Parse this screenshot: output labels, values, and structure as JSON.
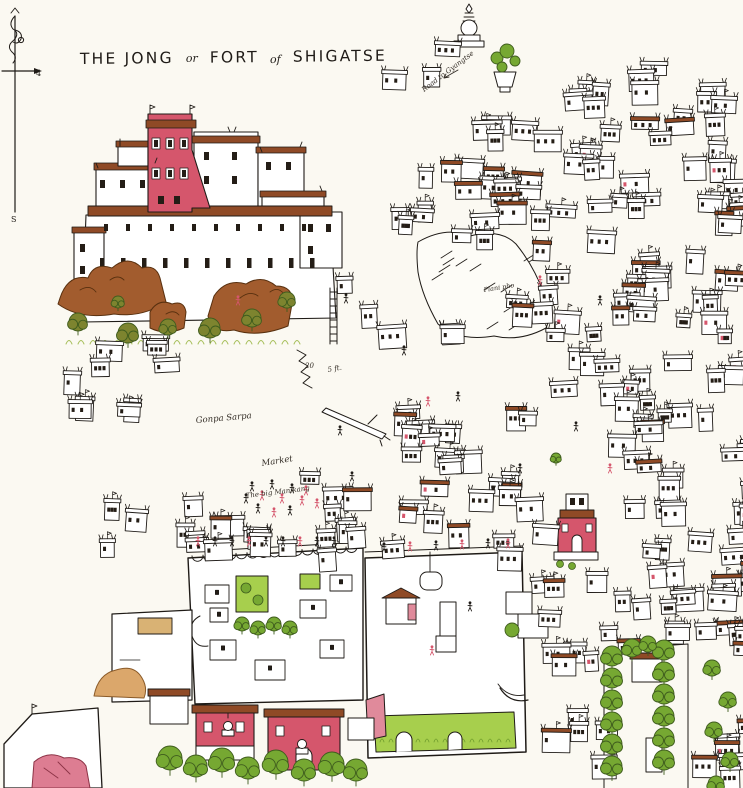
{
  "map": {
    "title": {
      "part1": "THE JONG",
      "part2": "or",
      "part3": "FORT",
      "part4": "of",
      "part5": "SHIGATSE"
    },
    "compass": {
      "south_label": "S",
      "scale_label": "4"
    },
    "labels": {
      "road_to_gyangtse": "Road to Gyangtse",
      "gonpa_sarpa": "Gonpa Sarpa",
      "market": "Market",
      "big_manikang": "The big Manikang",
      "plani_pho": "Plani pho",
      "steps_count": "20",
      "steps_size": "5 ft."
    },
    "colors": {
      "paper": "#fbf9f2",
      "ink": "#1f1b17",
      "crimson": "#d5566c",
      "crimson_light": "#e08a9b",
      "roof_brown": "#8f4a26",
      "rock_brown": "#a25c2e",
      "leaf_green": "#76a832",
      "lawn_green": "#a7cf4d",
      "olive_green": "#7d842f",
      "tan": "#d9b274"
    }
  }
}
